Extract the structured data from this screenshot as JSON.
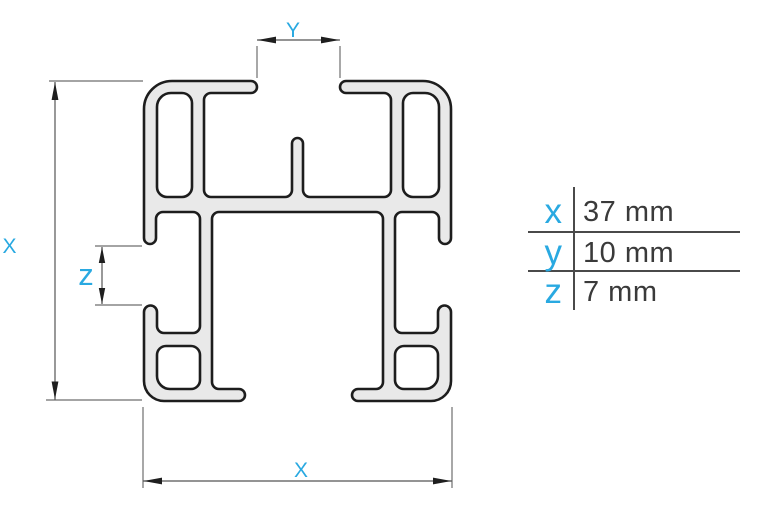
{
  "drawing": {
    "description": "Technical cross-section drawing of an aluminium profile bar with dimension lines",
    "labels": {
      "top": "Y",
      "left": "X",
      "side": "z",
      "bottom": "X"
    }
  },
  "table": {
    "rows": [
      {
        "key": "x",
        "value": "37 mm"
      },
      {
        "key": "y",
        "value": "10 mm"
      },
      {
        "key": "z",
        "value": "7 mm"
      }
    ]
  },
  "colors": {
    "accent": "#29a9e1",
    "profile_fill": "#e9e9e9",
    "profile_outline": "#1d1d1d",
    "dimension_line": "#555555",
    "extension_line": "#6e6e6e",
    "arrow": "#1f1f1f",
    "table_text": "#3a3a3a",
    "table_rule": "#4a4a4a"
  }
}
